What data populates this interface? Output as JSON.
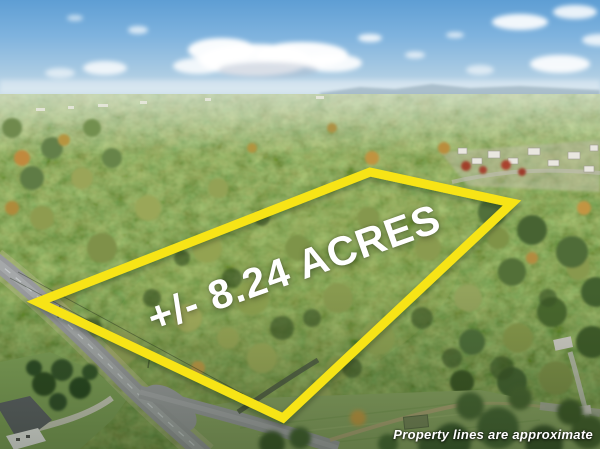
{
  "overlay": {
    "acreage_label": "+/- 8.24 ACRES",
    "disclaimer": "Property lines are approximate"
  },
  "colors": {
    "boundary": "#F7E414",
    "overlay_text": "#FFFFFF",
    "sky": "#6FA8D8",
    "forest": "#5E7C42",
    "road": "#97999B"
  }
}
